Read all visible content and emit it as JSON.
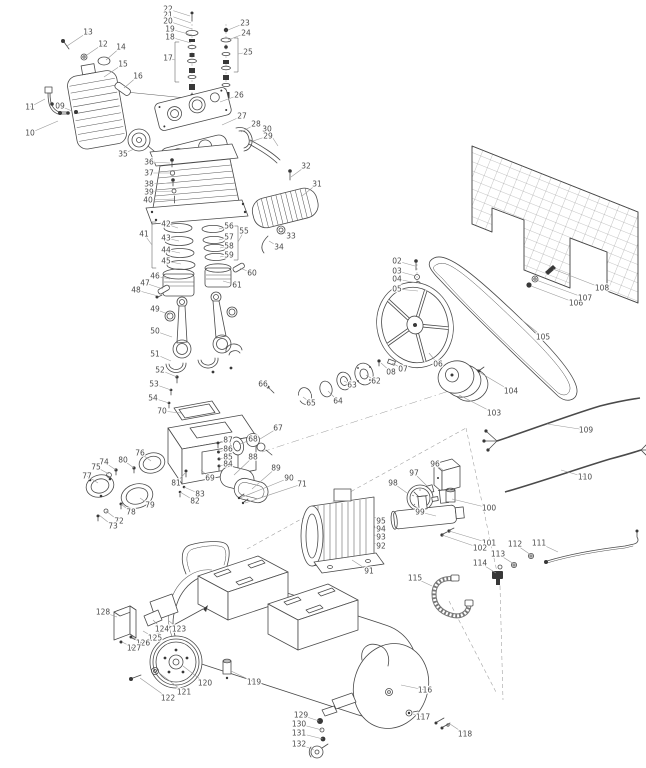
{
  "figure": {
    "type": "exploded-parts-diagram",
    "subject": "belt-drive air compressor"
  },
  "colors": {
    "background": "#ffffff",
    "line": "#4a4a4a",
    "label_text": "#4a4a4a",
    "leader_line": "#999999"
  },
  "callouts": [
    {
      "n": "13",
      "x": 88,
      "y": 32,
      "tx": 67,
      "ty": 46
    },
    {
      "n": "12",
      "x": 103,
      "y": 44,
      "tx": 84,
      "ty": 57
    },
    {
      "n": "14",
      "x": 121,
      "y": 47,
      "tx": 106,
      "ty": 60
    },
    {
      "n": "15",
      "x": 123,
      "y": 64,
      "tx": 104,
      "ty": 77
    },
    {
      "n": "16",
      "x": 138,
      "y": 76,
      "tx": 124,
      "ty": 88
    },
    {
      "n": "11",
      "x": 30,
      "y": 107,
      "tx": 45,
      "ty": 99
    },
    {
      "n": "09",
      "x": 60,
      "y": 106,
      "tx": 72,
      "ty": 111
    },
    {
      "n": "10",
      "x": 30,
      "y": 133,
      "tx": 58,
      "ty": 121
    },
    {
      "n": "22",
      "x": 168,
      "y": 9,
      "tx": 190,
      "ty": 16
    },
    {
      "n": "21",
      "x": 168,
      "y": 15,
      "tx": 191,
      "ty": 23
    },
    {
      "n": "20",
      "x": 168,
      "y": 21,
      "tx": 192,
      "ty": 29
    },
    {
      "n": "19",
      "x": 170,
      "y": 29,
      "tx": 192,
      "ty": 35
    },
    {
      "n": "18",
      "x": 170,
      "y": 37,
      "tx": 191,
      "ty": 43
    },
    {
      "n": "17",
      "x": 168,
      "y": 58,
      "tx": 175,
      "ty": 60
    },
    {
      "n": "23",
      "x": 245,
      "y": 23,
      "tx": 228,
      "ty": 30
    },
    {
      "n": "24",
      "x": 246,
      "y": 33,
      "tx": 228,
      "ty": 40
    },
    {
      "n": "25",
      "x": 248,
      "y": 52,
      "tx": 238,
      "ty": 54
    },
    {
      "n": "26",
      "x": 239,
      "y": 95,
      "tx": 220,
      "ty": 102
    },
    {
      "n": "27",
      "x": 242,
      "y": 116,
      "tx": 222,
      "ty": 125
    },
    {
      "n": "28",
      "x": 256,
      "y": 124,
      "tx": 241,
      "ty": 132
    },
    {
      "n": "30",
      "x": 267,
      "y": 129,
      "tx": 278,
      "ty": 146
    },
    {
      "n": "29",
      "x": 268,
      "y": 136,
      "tx": 250,
      "ty": 142
    },
    {
      "n": "32",
      "x": 306,
      "y": 166,
      "tx": 291,
      "ty": 177
    },
    {
      "n": "31",
      "x": 317,
      "y": 184,
      "tx": 302,
      "ty": 196
    },
    {
      "n": "33",
      "x": 291,
      "y": 236,
      "tx": 281,
      "ty": 231
    },
    {
      "n": "34",
      "x": 279,
      "y": 247,
      "tx": 269,
      "ty": 241
    },
    {
      "n": "35",
      "x": 123,
      "y": 154,
      "tx": 134,
      "ty": 149
    },
    {
      "n": "36",
      "x": 149,
      "y": 162,
      "tx": 170,
      "ty": 163
    },
    {
      "n": "37",
      "x": 149,
      "y": 173,
      "tx": 171,
      "ty": 173
    },
    {
      "n": "38",
      "x": 149,
      "y": 184,
      "tx": 172,
      "ty": 183
    },
    {
      "n": "39",
      "x": 149,
      "y": 192,
      "tx": 173,
      "ty": 191
    },
    {
      "n": "40",
      "x": 148,
      "y": 200,
      "tx": 174,
      "ty": 199
    },
    {
      "n": "41",
      "x": 144,
      "y": 234,
      "tx": 152,
      "ty": 245
    },
    {
      "n": "42",
      "x": 166,
      "y": 224,
      "tx": 178,
      "ty": 228
    },
    {
      "n": "43",
      "x": 166,
      "y": 238,
      "tx": 179,
      "ty": 241
    },
    {
      "n": "44",
      "x": 166,
      "y": 250,
      "tx": 180,
      "ty": 253
    },
    {
      "n": "45",
      "x": 166,
      "y": 261,
      "tx": 181,
      "ty": 264
    },
    {
      "n": "46",
      "x": 155,
      "y": 276,
      "tx": 170,
      "ty": 279
    },
    {
      "n": "47",
      "x": 145,
      "y": 283,
      "tx": 163,
      "ty": 289
    },
    {
      "n": "48",
      "x": 136,
      "y": 290,
      "tx": 158,
      "ty": 296
    },
    {
      "n": "49",
      "x": 155,
      "y": 309,
      "tx": 170,
      "ty": 315
    },
    {
      "n": "50",
      "x": 155,
      "y": 331,
      "tx": 172,
      "ty": 337
    },
    {
      "n": "55",
      "x": 244,
      "y": 231,
      "tx": 238,
      "ty": 242
    },
    {
      "n": "56",
      "x": 229,
      "y": 226,
      "tx": 219,
      "ty": 229
    },
    {
      "n": "57",
      "x": 229,
      "y": 237,
      "tx": 219,
      "ty": 240
    },
    {
      "n": "58",
      "x": 229,
      "y": 246,
      "tx": 220,
      "ty": 248
    },
    {
      "n": "59",
      "x": 229,
      "y": 255,
      "tx": 220,
      "ty": 257
    },
    {
      "n": "60",
      "x": 252,
      "y": 273,
      "tx": 240,
      "ty": 268
    },
    {
      "n": "61",
      "x": 237,
      "y": 285,
      "tx": 223,
      "ty": 281
    },
    {
      "n": "51",
      "x": 155,
      "y": 354,
      "tx": 171,
      "ty": 361
    },
    {
      "n": "52",
      "x": 160,
      "y": 370,
      "tx": 177,
      "ty": 377
    },
    {
      "n": "53",
      "x": 154,
      "y": 384,
      "tx": 171,
      "ty": 390
    },
    {
      "n": "54",
      "x": 153,
      "y": 398,
      "tx": 169,
      "ty": 403
    },
    {
      "n": "70",
      "x": 162,
      "y": 411,
      "tx": 181,
      "ty": 413
    },
    {
      "n": "66",
      "x": 263,
      "y": 384,
      "tx": 271,
      "ty": 390
    },
    {
      "n": "65",
      "x": 311,
      "y": 403,
      "tx": 303,
      "ty": 397
    },
    {
      "n": "67",
      "x": 278,
      "y": 428,
      "tx": 260,
      "ty": 439
    },
    {
      "n": "68",
      "x": 253,
      "y": 439,
      "tx": 240,
      "ty": 444
    },
    {
      "n": "87",
      "x": 228,
      "y": 440,
      "tx": 219,
      "ty": 443
    },
    {
      "n": "86",
      "x": 228,
      "y": 449,
      "tx": 219,
      "ty": 452
    },
    {
      "n": "85",
      "x": 228,
      "y": 457,
      "tx": 219,
      "ty": 459
    },
    {
      "n": "84",
      "x": 228,
      "y": 464,
      "tx": 219,
      "ty": 466
    },
    {
      "n": "69",
      "x": 210,
      "y": 478,
      "tx": 201,
      "ty": 470
    },
    {
      "n": "81",
      "x": 176,
      "y": 483,
      "tx": 186,
      "ty": 472
    },
    {
      "n": "83",
      "x": 200,
      "y": 494,
      "tx": 184,
      "ty": 487
    },
    {
      "n": "82",
      "x": 195,
      "y": 501,
      "tx": 180,
      "ty": 492
    },
    {
      "n": "88",
      "x": 253,
      "y": 457,
      "tx": 234,
      "ty": 475
    },
    {
      "n": "89",
      "x": 276,
      "y": 468,
      "tx": 252,
      "ty": 489
    },
    {
      "n": "90",
      "x": 289,
      "y": 478,
      "tx": 240,
      "ty": 498
    },
    {
      "n": "71",
      "x": 302,
      "y": 484,
      "tx": 245,
      "ty": 503
    },
    {
      "n": "76",
      "x": 140,
      "y": 453,
      "tx": 151,
      "ty": 461
    },
    {
      "n": "80",
      "x": 123,
      "y": 460,
      "tx": 134,
      "ty": 468
    },
    {
      "n": "74",
      "x": 104,
      "y": 462,
      "tx": 116,
      "ty": 470
    },
    {
      "n": "75",
      "x": 96,
      "y": 467,
      "tx": 109,
      "ty": 474
    },
    {
      "n": "77",
      "x": 87,
      "y": 476,
      "tx": 98,
      "ty": 483
    },
    {
      "n": "79",
      "x": 150,
      "y": 505,
      "tx": 140,
      "ty": 498
    },
    {
      "n": "78",
      "x": 131,
      "y": 512,
      "tx": 121,
      "ty": 504
    },
    {
      "n": "72",
      "x": 119,
      "y": 521,
      "tx": 106,
      "ty": 511
    },
    {
      "n": "73",
      "x": 113,
      "y": 526,
      "tx": 99,
      "ty": 515
    },
    {
      "n": "02",
      "x": 397,
      "y": 261,
      "tx": 415,
      "ty": 266
    },
    {
      "n": "03",
      "x": 397,
      "y": 271,
      "tx": 416,
      "ty": 276
    },
    {
      "n": "04",
      "x": 397,
      "y": 279,
      "tx": 417,
      "ty": 283
    },
    {
      "n": "05",
      "x": 397,
      "y": 289,
      "tx": 418,
      "ty": 291
    },
    {
      "n": "06",
      "x": 438,
      "y": 364,
      "tx": 429,
      "ty": 353
    },
    {
      "n": "07",
      "x": 403,
      "y": 369,
      "tx": 392,
      "ty": 363
    },
    {
      "n": "08",
      "x": 391,
      "y": 372,
      "tx": 381,
      "ty": 363
    },
    {
      "n": "62",
      "x": 376,
      "y": 381,
      "tx": 366,
      "ty": 375
    },
    {
      "n": "63",
      "x": 352,
      "y": 385,
      "tx": 344,
      "ty": 381
    },
    {
      "n": "64",
      "x": 338,
      "y": 401,
      "tx": 328,
      "ty": 391
    },
    {
      "n": "103",
      "x": 494,
      "y": 413,
      "tx": 459,
      "ty": 395
    },
    {
      "n": "104",
      "x": 511,
      "y": 391,
      "tx": 479,
      "ty": 372
    },
    {
      "n": "105",
      "x": 543,
      "y": 337,
      "tx": 522,
      "ty": 320
    },
    {
      "n": "106",
      "x": 576,
      "y": 303,
      "tx": 531,
      "ty": 286
    },
    {
      "n": "107",
      "x": 585,
      "y": 298,
      "tx": 536,
      "ty": 280
    },
    {
      "n": "108",
      "x": 602,
      "y": 288,
      "tx": 553,
      "ty": 269
    },
    {
      "n": "109",
      "x": 586,
      "y": 430,
      "tx": 547,
      "ty": 424
    },
    {
      "n": "110",
      "x": 585,
      "y": 477,
      "tx": 561,
      "ty": 470
    },
    {
      "n": "96",
      "x": 435,
      "y": 464,
      "tx": 444,
      "ty": 471
    },
    {
      "n": "97",
      "x": 414,
      "y": 473,
      "tx": 427,
      "ty": 486
    },
    {
      "n": "98",
      "x": 393,
      "y": 483,
      "tx": 407,
      "ty": 493
    },
    {
      "n": "99",
      "x": 420,
      "y": 512,
      "tx": 436,
      "ty": 516
    },
    {
      "n": "100",
      "x": 489,
      "y": 508,
      "tx": 452,
      "ty": 499
    },
    {
      "n": "101",
      "x": 489,
      "y": 543,
      "tx": 449,
      "ty": 531
    },
    {
      "n": "102",
      "x": 480,
      "y": 548,
      "tx": 442,
      "ty": 535
    },
    {
      "n": "95",
      "x": 381,
      "y": 521,
      "tx": 374,
      "ty": 517
    },
    {
      "n": "94",
      "x": 381,
      "y": 529,
      "tx": 374,
      "ty": 527
    },
    {
      "n": "93",
      "x": 381,
      "y": 537,
      "tx": 374,
      "ty": 535
    },
    {
      "n": "92",
      "x": 381,
      "y": 546,
      "tx": 374,
      "ty": 543
    },
    {
      "n": "91",
      "x": 369,
      "y": 571,
      "tx": 352,
      "ty": 560
    },
    {
      "n": "111",
      "x": 539,
      "y": 543,
      "tx": 558,
      "ty": 552
    },
    {
      "n": "112",
      "x": 515,
      "y": 544,
      "tx": 531,
      "ty": 555
    },
    {
      "n": "113",
      "x": 498,
      "y": 554,
      "tx": 514,
      "ty": 564
    },
    {
      "n": "114",
      "x": 480,
      "y": 563,
      "tx": 496,
      "ty": 573
    },
    {
      "n": "115",
      "x": 415,
      "y": 578,
      "tx": 432,
      "ty": 586
    },
    {
      "n": "116",
      "x": 425,
      "y": 690,
      "tx": 401,
      "ty": 685
    },
    {
      "n": "117",
      "x": 423,
      "y": 717,
      "tx": 413,
      "ty": 714
    },
    {
      "n": "118",
      "x": 465,
      "y": 734,
      "tx": 450,
      "ty": 724
    },
    {
      "n": "119",
      "x": 254,
      "y": 682,
      "tx": 231,
      "ty": 671
    },
    {
      "n": "120",
      "x": 205,
      "y": 683,
      "tx": 183,
      "ty": 666
    },
    {
      "n": "121",
      "x": 184,
      "y": 692,
      "tx": 158,
      "ty": 672
    },
    {
      "n": "122",
      "x": 168,
      "y": 698,
      "tx": 140,
      "ty": 678
    },
    {
      "n": "123",
      "x": 179,
      "y": 629,
      "tx": 169,
      "ty": 621
    },
    {
      "n": "124",
      "x": 162,
      "y": 629,
      "tx": 153,
      "ty": 620
    },
    {
      "n": "125",
      "x": 155,
      "y": 638,
      "tx": 143,
      "ty": 631
    },
    {
      "n": "126",
      "x": 143,
      "y": 643,
      "tx": 132,
      "ty": 637
    },
    {
      "n": "127",
      "x": 134,
      "y": 648,
      "tx": 122,
      "ty": 642
    },
    {
      "n": "128",
      "x": 103,
      "y": 612,
      "tx": 117,
      "ty": 617
    },
    {
      "n": "129",
      "x": 301,
      "y": 715,
      "tx": 319,
      "ty": 721
    },
    {
      "n": "130",
      "x": 299,
      "y": 724,
      "tx": 322,
      "ty": 730
    },
    {
      "n": "131",
      "x": 299,
      "y": 733,
      "tx": 323,
      "ty": 739
    },
    {
      "n": "132",
      "x": 299,
      "y": 744,
      "tx": 314,
      "ty": 750
    }
  ]
}
